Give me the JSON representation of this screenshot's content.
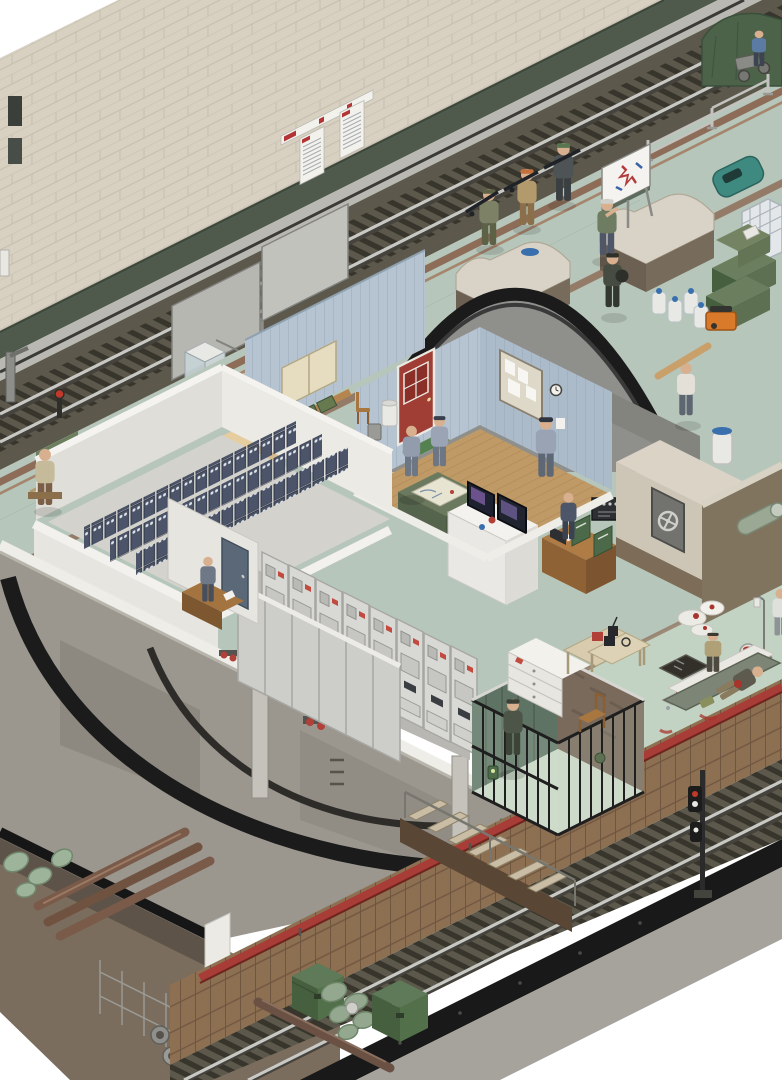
{
  "scene": {
    "title": "Isometric cutaway illustration of a metro station converted into a fortified shelter",
    "levels": [
      "station platform hall",
      "service bunker rooms",
      "under-platform utility level",
      "lower railway tunnel",
      "excavated trench"
    ]
  },
  "palette": {
    "bg": "#ffffff",
    "wallTile": "#d8d1c2",
    "wallGrout": "#c6bfae",
    "wallBase": "#4f5a4c",
    "ledge": "#b9b8b2",
    "trackBed": "#5c584c",
    "sleeper": "#38352c",
    "rail": "#c8c8c4",
    "platform": "#b7c6ba",
    "stripeBrown": "#8d6d58",
    "medFloor": "#c3d3c3",
    "slab": "#efede8",
    "subConcrete": "#9b978f",
    "ringBlack": "#1b1b1b",
    "dirt": "#7b6d5d",
    "dirtWall": "#5d5348",
    "wood": "#8d6f52",
    "woodDark": "#6f5640",
    "redPipe": "#a83c36",
    "bunkerWhite": "#e8e6e0",
    "roomBlue": "#b6c3d0",
    "woodFloor": "#c09a66",
    "battery": "#4b5468",
    "crate": "#d9bd90",
    "ammoGreen": "#5d7052",
    "cabinet": "#d8d8d4",
    "cabinetFront": "#cdcdc9",
    "doorRed": "#a03e35",
    "roofGray": "#8f8f8b",
    "vaultBeige": "#cdc5b6",
    "cageWall": "#5f7364",
    "cageFloor": "#cddac9",
    "deskWood": "#b07c46",
    "marble": "#80745f",
    "stone": "#756a5c",
    "benchTop": "#d9d2c6",
    "trunkGreen": "#5d7052",
    "bottleWhite": "#e8e8e4",
    "blueLid": "#3a6fae",
    "generatorOrange": "#d97a2a",
    "toteWhite": "#e3e7ea",
    "machineTeal": "#3f8a80",
    "tarpGreen": "#4d6349",
    "matOlive": "#7d8577",
    "blood": "#a8342c",
    "bandage": "#eceae4",
    "uniformCamo": "#929cad",
    "skin": "#d8b08f"
  },
  "signage": {
    "wall_route_list_signs": 2,
    "wall_red_line_bar_signs": 2,
    "blank_metal_sign_boards": 2
  },
  "inventory": {
    "regions": [
      "station-wall",
      "upper-track",
      "platform",
      "bunker-complex",
      "switchgear-hall",
      "battery-room",
      "store-room",
      "command-room",
      "vault-annex",
      "sub-level",
      "holding-cage",
      "medical-station",
      "lower-tunnel",
      "excavation-trench"
    ],
    "figures": [
      "seated-civilian",
      "duty-clerk",
      "map-officer-1",
      "map-officer-2",
      "standing-officer",
      "radio-operator",
      "briefing-instructor",
      "fighter-1",
      "fighter-2",
      "fighter-3",
      "running-courier",
      "plank-carrier",
      "squatting-man",
      "prisoner",
      "medic",
      "wounded-person",
      "nurse"
    ],
    "equipment": [
      "flipchart-easel",
      "crowd-barriers",
      "display-case",
      "sign-boards",
      "battery-rows",
      "switchgear-cabinets",
      "map-table",
      "monitors",
      "radio-rack",
      "vault-hatch",
      "green-trunks",
      "water-bottles",
      "portable-generator",
      "ibc-tote",
      "cleaning-machine",
      "iv-stand",
      "first-aid-case",
      "sandbag-barricade",
      "ammo-chests",
      "pipe-stack",
      "wire-mesh",
      "signal-mast",
      "stairs-to-tunnel"
    ]
  },
  "counts": {
    "battery_rows": 3,
    "switchgear_cabinets_back_row": 8,
    "briefing_fighters": 3,
    "green_trunks": 3,
    "water_bottles": 4
  }
}
